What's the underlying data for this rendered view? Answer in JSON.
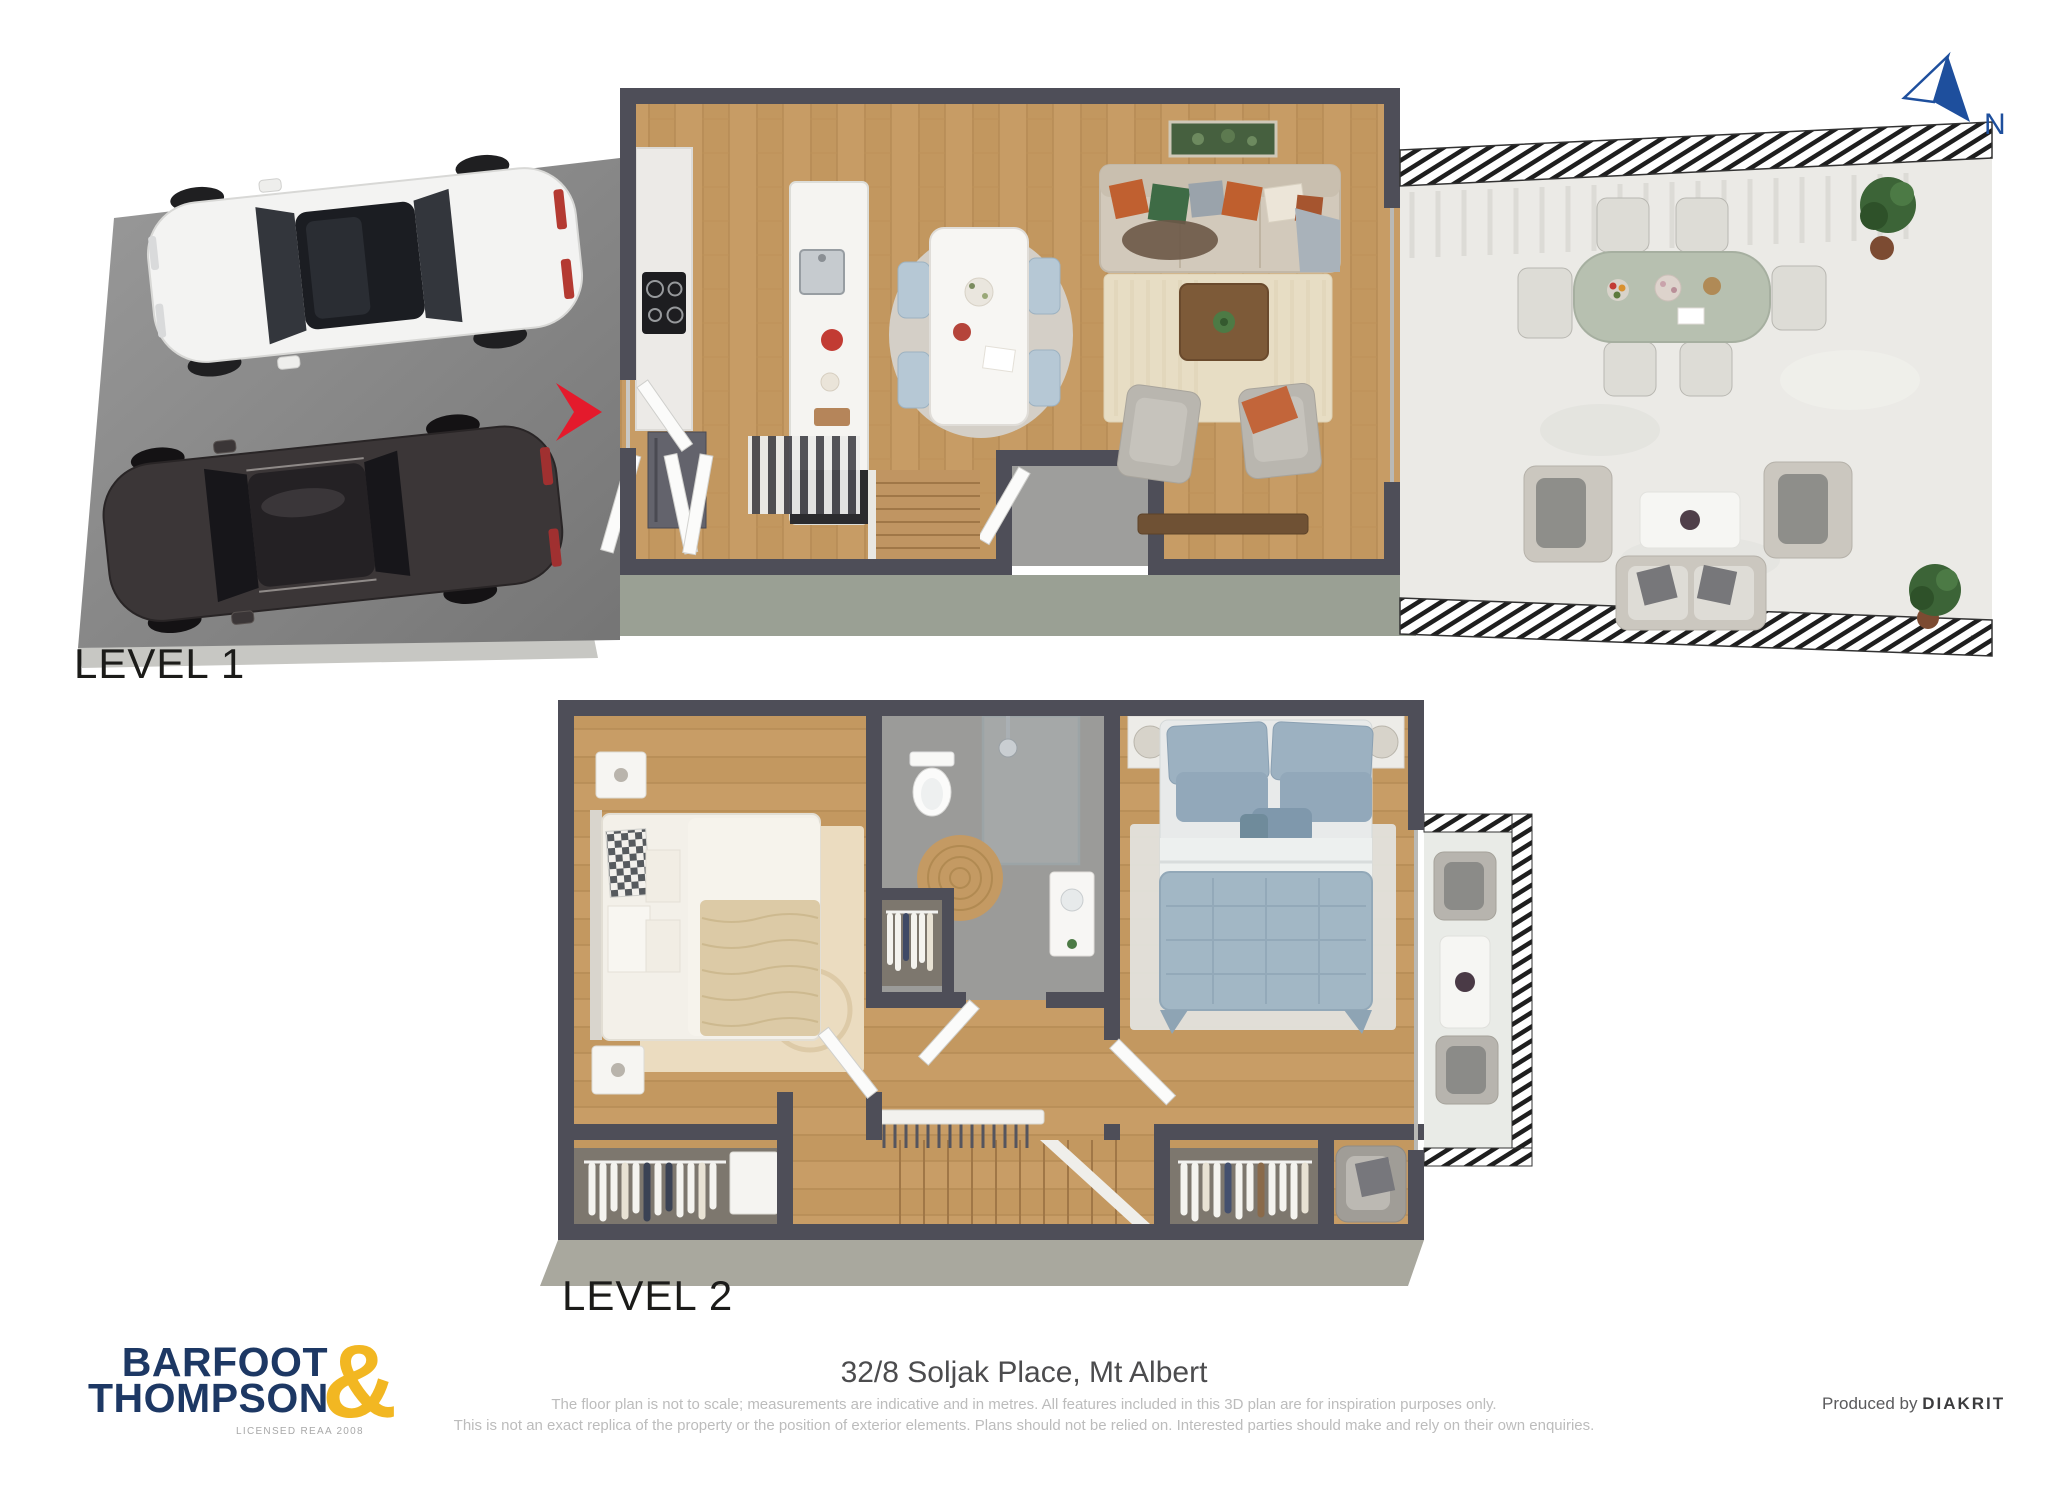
{
  "compass": {
    "label": "N",
    "color": "#1e4f9d"
  },
  "levels": [
    {
      "label": "LEVEL 1"
    },
    {
      "label": "LEVEL 2"
    }
  ],
  "footer": {
    "brand": {
      "line1": "BARFOOT",
      "ampersand": "&",
      "line2": "THOMPSON",
      "license": "LICENSED REAA 2008",
      "navy": "#1d3864",
      "gold": "#f2b722"
    },
    "address": "32/8 Soljak Place, Mt Albert",
    "disclaimer_line1": "The floor plan is not to scale; measurements are indicative and in metres. All features included in this 3D plan are for inspiration purposes only.",
    "disclaimer_line2": "This is not an exact replica of the property or the position of exterior elements. Plans should not be relied on. Interested parties should make and rely on their own enquiries.",
    "produced_by_label": "Produced by",
    "producer": "DIAKRIT"
  },
  "palette": {
    "wall": "#4e4e58",
    "wood_floor": "#c79c65",
    "deck_concrete": "#ebeae6",
    "driveway_asphalt": "#8e8e8e",
    "entry_arrow_red": "#e41a2c"
  }
}
